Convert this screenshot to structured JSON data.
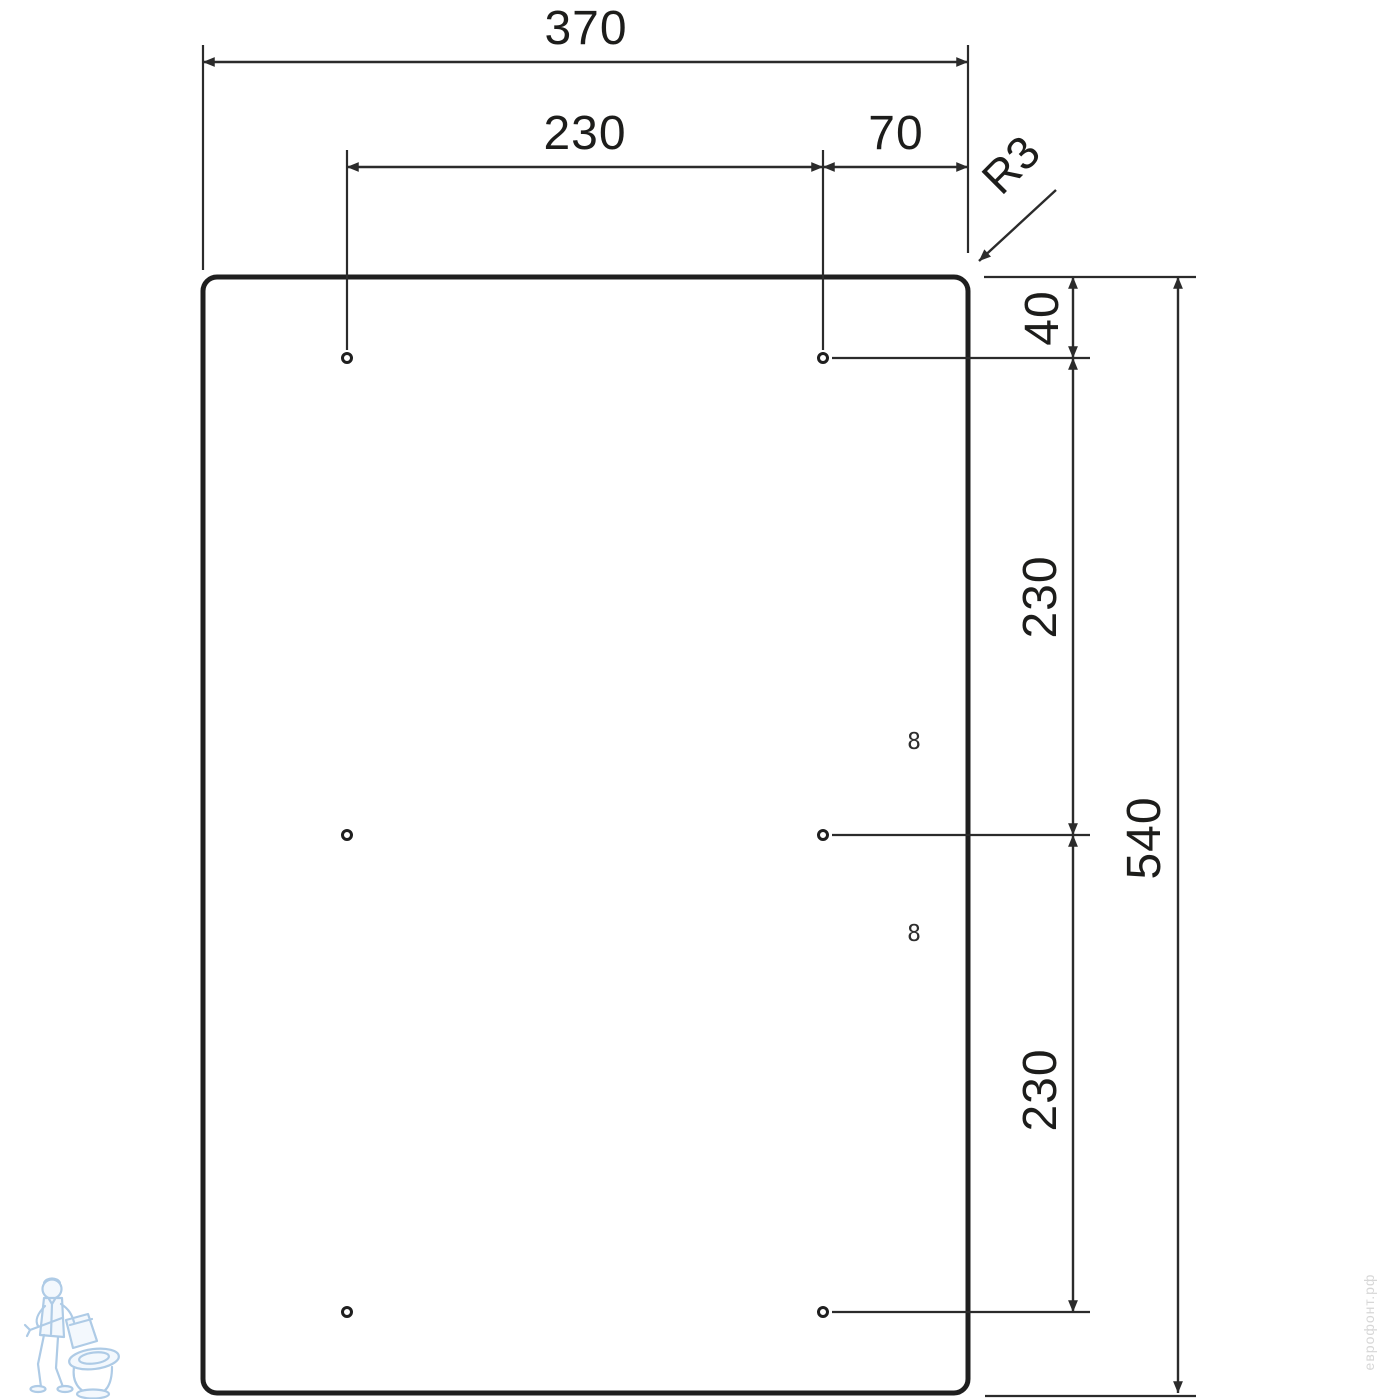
{
  "drawing": {
    "type": "technical-dimension-drawing",
    "part": "rectangular panel with rounded corners, six mounting holes",
    "labels": {
      "width_total": "370",
      "width_holes": "230",
      "width_edge": "70",
      "corner_radius": "R3",
      "top_offset": "40",
      "row_gap_upper": "230",
      "row_gap_lower": "230",
      "height_total": "540",
      "hole_mark_upper": "8",
      "hole_mark_lower": "8"
    },
    "units_implied": "mm",
    "colors": {
      "line": "#1f1f1f",
      "dimension_line": "#2b2b2b",
      "background": "#ffffff",
      "watermark_blue": "#aecbe6",
      "watermark_text_gray": "#d7d7d7"
    }
  },
  "watermark": {
    "site_text": "еврофонт.рф",
    "logo": "plumber-with-toilet"
  }
}
